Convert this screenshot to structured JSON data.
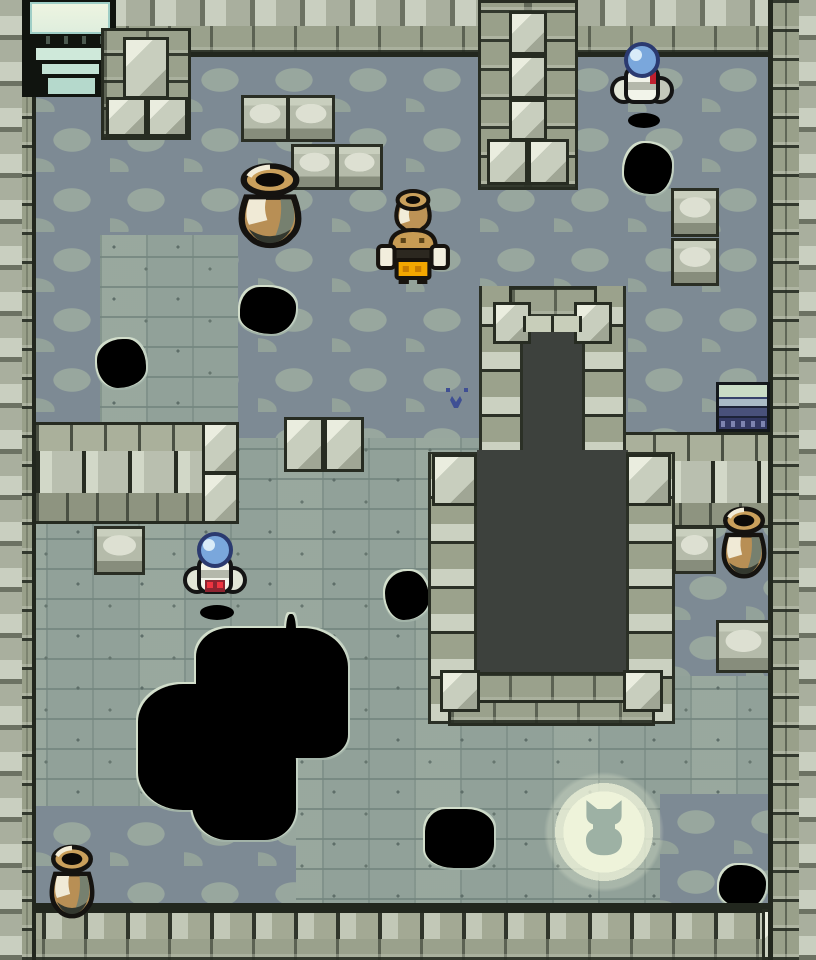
{
  "scene": {
    "title": "dungeon-room",
    "description": "Top-down Game Boy Color style dungeon room with pits, jars, orb robots and a glowing cat sigil",
    "colors": {
      "floor_light": "#91a199",
      "floor_dark": "#7d8a94",
      "wall": "#9aa18c",
      "wall_block_light": "#c9cfc0",
      "pit_interior": "#3d413d",
      "hole": "#000000",
      "hole_crack_edge": "#d2decb",
      "glow": "#eef3da",
      "glow_sigil": "#9db1a4",
      "jar_brown": "#b88f55",
      "enemy_orb_blue": "#7aa7dc",
      "enemy_accent_red": "#c01f2e",
      "player_shorts_orange": "#f2a600",
      "stairs_navy": "#333963",
      "entrance_light": "#edf4e0"
    },
    "counts": {
      "enemies": 2,
      "jars": 3,
      "floor_holes": 7,
      "carved_blocks": 9
    }
  },
  "entities": {
    "entrance_top_left": {
      "x": 22,
      "y": 0,
      "w": 94,
      "h": 97
    },
    "stairs_down_tile": {
      "x": 716,
      "y": 382,
      "w": 54,
      "h": 50
    },
    "player": {
      "x": 374,
      "y": 184,
      "w": 78,
      "h": 100
    },
    "enemies": [
      {
        "x": 610,
        "y": 42,
        "w": 64,
        "h": 86
      },
      {
        "x": 182,
        "y": 532,
        "w": 66,
        "h": 88
      }
    ],
    "jars": [
      {
        "x": 228,
        "y": 158,
        "w": 84,
        "h": 92
      },
      {
        "x": 714,
        "y": 502,
        "w": 60,
        "h": 78
      },
      {
        "x": 42,
        "y": 840,
        "w": 60,
        "h": 80
      }
    ],
    "carved_blocks": [
      {
        "x": 241,
        "y": 95,
        "w": 48,
        "h": 47
      },
      {
        "x": 287,
        "y": 95,
        "w": 48,
        "h": 47
      },
      {
        "x": 291,
        "y": 144,
        "w": 47,
        "h": 46
      },
      {
        "x": 336,
        "y": 144,
        "w": 47,
        "h": 46
      },
      {
        "x": 671,
        "y": 188,
        "w": 48,
        "h": 49
      },
      {
        "x": 671,
        "y": 238,
        "w": 48,
        "h": 48
      },
      {
        "x": 94,
        "y": 526,
        "w": 51,
        "h": 49
      },
      {
        "x": 673,
        "y": 526,
        "w": 43,
        "h": 48
      },
      {
        "x": 716,
        "y": 620,
        "w": 55,
        "h": 53
      }
    ],
    "block_pair": {
      "x": 284,
      "y": 417,
      "w": 80,
      "h": 55
    },
    "holes": [
      {
        "x": 236,
        "y": 283,
        "w": 64,
        "h": 55
      },
      {
        "x": 93,
        "y": 335,
        "w": 57,
        "h": 57
      },
      {
        "x": 620,
        "y": 139,
        "w": 56,
        "h": 59
      },
      {
        "x": 381,
        "y": 567,
        "w": 52,
        "h": 57
      },
      {
        "x": 421,
        "y": 805,
        "w": 77,
        "h": 67
      },
      {
        "x": 715,
        "y": 861,
        "w": 55,
        "h": 51
      }
    ],
    "big_hole": {
      "x": 130,
      "y": 616,
      "w": 225,
      "h": 224
    },
    "glow_circle": {
      "x": 534,
      "y": 762,
      "w": 140,
      "h": 140
    },
    "blue_critter": {
      "x": 444,
      "y": 386,
      "w": 26,
      "h": 28
    }
  }
}
